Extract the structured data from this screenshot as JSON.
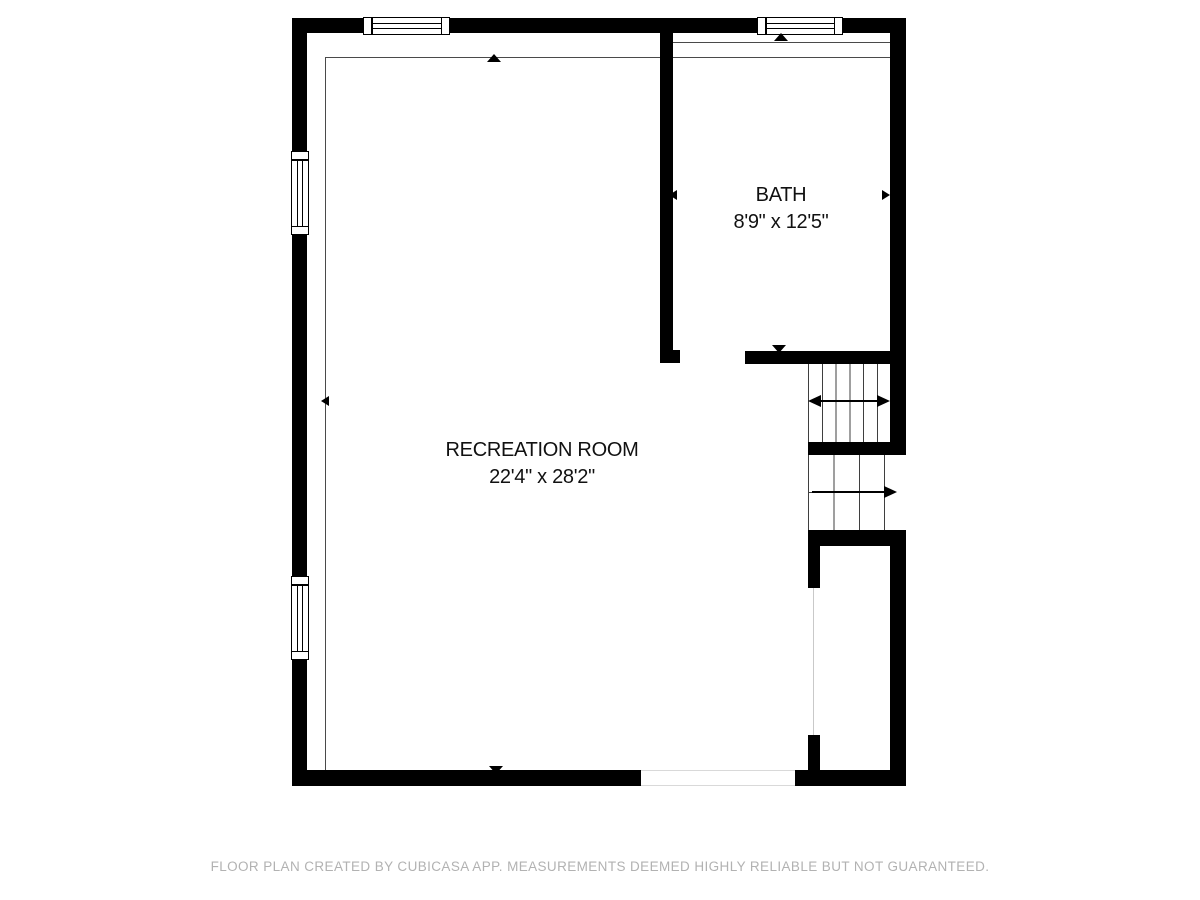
{
  "colors": {
    "walls": "#000000",
    "room_outline": "#4a4a4a",
    "stair_lines": "#3f3f3f",
    "footer_text": "#b2b2b2",
    "background": "#ffffff"
  },
  "rooms": {
    "bath": {
      "name": "BATH",
      "dimensions": "8'9\" x 12'5\""
    },
    "recreation": {
      "name": "RECREATION ROOM",
      "dimensions": "22'4\" x 28'2\""
    }
  },
  "footer": {
    "text": "FLOOR PLAN CREATED BY CUBICASA APP. MEASUREMENTS DEEMED HIGHLY RELIABLE BUT NOT GUARANTEED."
  }
}
